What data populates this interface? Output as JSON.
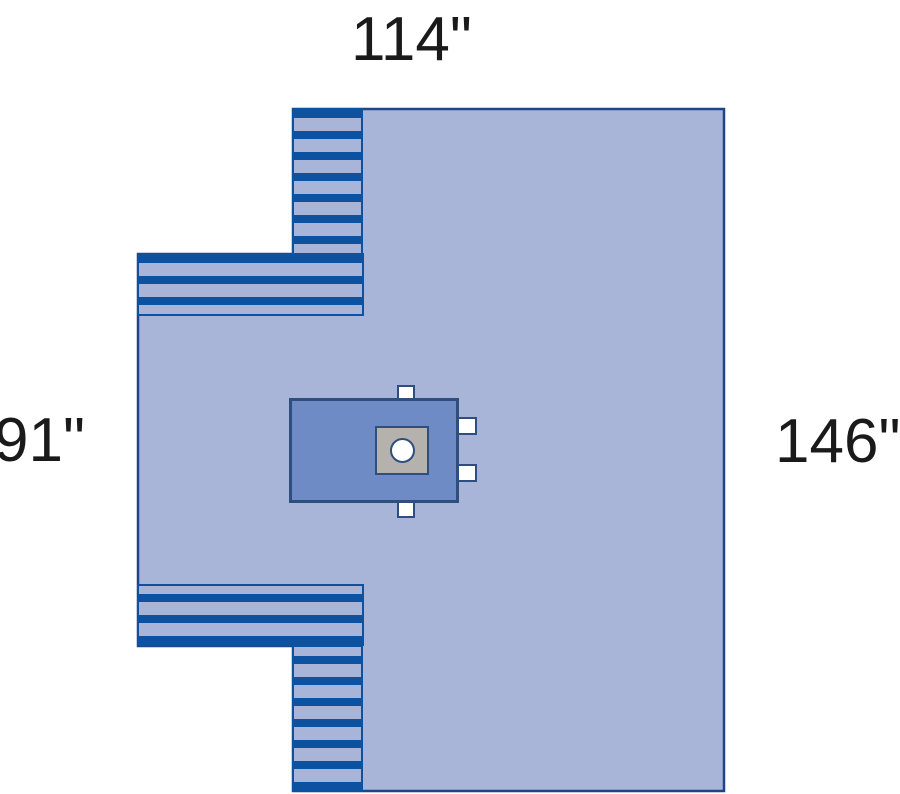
{
  "diagram": {
    "labels": {
      "top": "114\"",
      "left": "91\"",
      "right": "146\""
    },
    "colors": {
      "drape_fill": "#A9B5D8",
      "stripe_blue": "#0D52A0",
      "outline_navy": "#1E4489",
      "fenestration_panel_fill": "#6E8BC5",
      "fenestration_border": "#2E4E7E",
      "pad_gray": "#B5B1AC",
      "tab_white": "#FFFFFF",
      "label_color": "#1A1A1A"
    }
  }
}
